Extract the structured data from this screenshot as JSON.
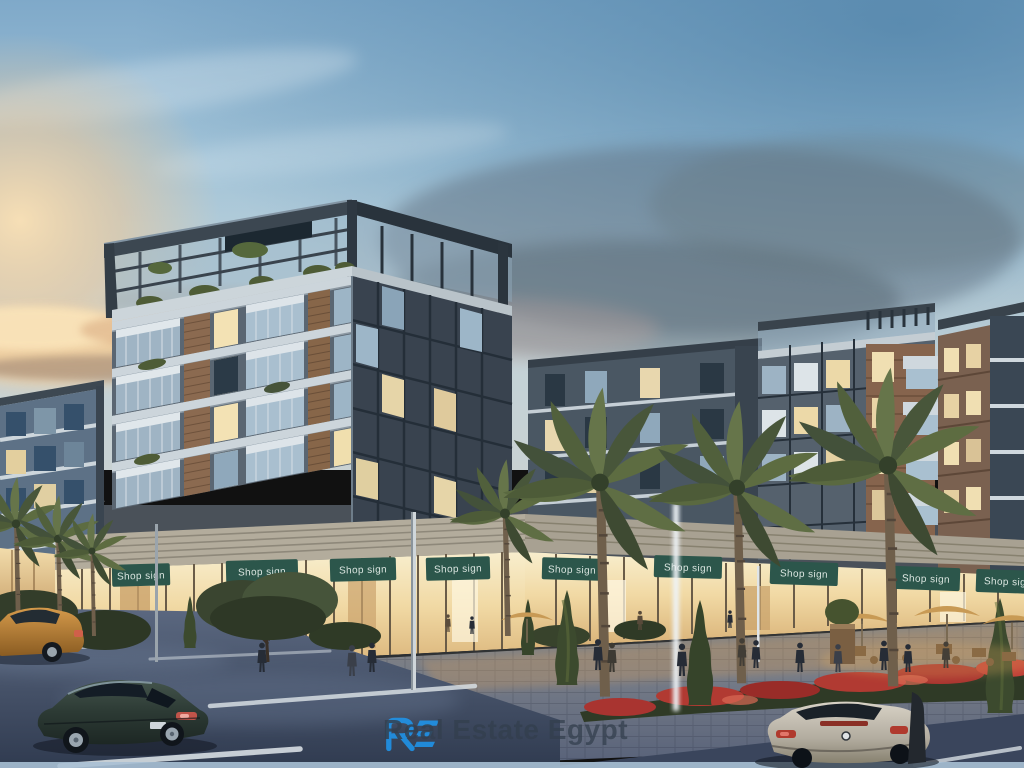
{
  "watermark": {
    "brand_mark": "RE",
    "text": "Real Estate Egypt",
    "brand_color": "#1e97f0",
    "text_color": "#333f4d"
  },
  "storefront": {
    "sign_label": "Shop sign",
    "sign_color": "#2c564b",
    "sign_text_color": "#e4ede8",
    "sign_count": 9
  },
  "scene": {
    "palette": {
      "sky_top": "#7fa9c9",
      "sky_haze": "#c3d2d9",
      "sunset_glow": "#f2cf9e",
      "cloud_dark": "#5f7080",
      "building_dark": "#47535f",
      "brick": "#8a6a52",
      "balcony": "#ccd5db",
      "window_lit": "#f2e1b6",
      "storefront_glow": "#f4e2bd",
      "palm_green": "#58663c",
      "road": "#3f4b61",
      "flowers_red": "#a93430"
    }
  }
}
